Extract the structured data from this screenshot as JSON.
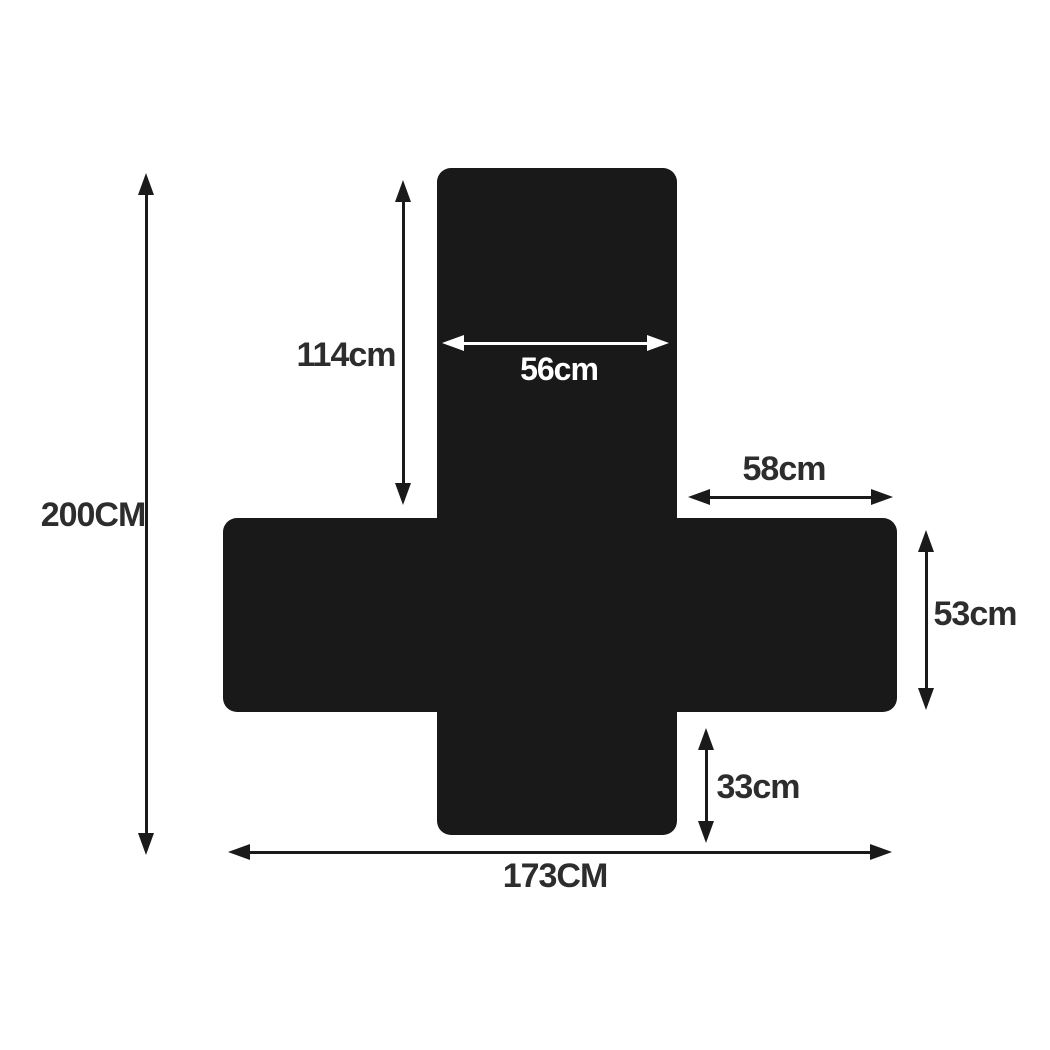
{
  "diagram": {
    "type": "product-dimension-diagram",
    "shape": "cross-shaped-flat-cover-silhouette",
    "dimensions": {
      "total_height": {
        "label": "200CM",
        "orientation": "vertical"
      },
      "back_panel_height": {
        "label": "114cm",
        "orientation": "vertical"
      },
      "back_panel_width": {
        "label": "56cm",
        "orientation": "horizontal"
      },
      "side_panel_width": {
        "label": "58cm",
        "orientation": "horizontal"
      },
      "side_panel_height": {
        "label": "53cm",
        "orientation": "vertical"
      },
      "front_skirt_height": {
        "label": "33cm",
        "orientation": "vertical"
      },
      "total_width": {
        "label": "173CM",
        "orientation": "horizontal"
      }
    },
    "colors": {
      "shape": "#191919",
      "dimension_lines": "#1a1a1a",
      "label_text": "#2d2d2d",
      "inner_label_text": "#ffffff",
      "background": "#ffffff"
    }
  }
}
